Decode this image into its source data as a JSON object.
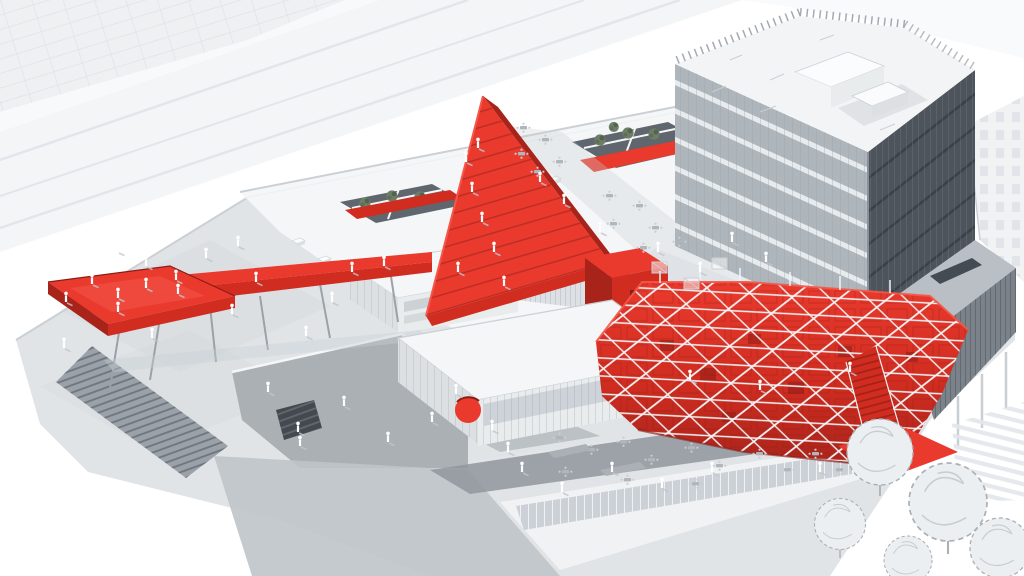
{
  "meta": {
    "title": "Aerial isometric architectural rendering of a white campus with bright red circulation structures",
    "medium": "3D architectural visualization",
    "view": "aerial axonometric"
  },
  "palette": {
    "bg": "#ffffff",
    "road": "#f3f5f7",
    "road_line": "#e2e6ea",
    "ghost": "#eef0f2",
    "ghost_line": "#dfe3e7",
    "ground": "#e0e4e7",
    "ground_sunken": "#abb0b5",
    "path_dark": "#90969c",
    "apron": "#bfc4c9",
    "plinth": "#f0f2f4",
    "roof_white": "#f4f6f8",
    "face_light": "#e9eced",
    "face_mid": "#dce0e3",
    "parapet": "#cbd0d4",
    "glass": "#bfc6cc",
    "mullion": "#9aa1a8",
    "louver_face": "#dde1e5",
    "louver_line": "#b6bcc2",
    "courtyard": "#5f666d",
    "tree": "#6e7e66",
    "tree_dark": "#4f5e49",
    "steps_fill": "#9aa1a8",
    "steps_line": "#6e757c",
    "stair_dark": "#44494f",
    "tower_roof": "#f2f4f6",
    "tower_left": "#aeb5bb",
    "tower_band": "#e8ebee",
    "tower_right": "#4e545c",
    "tower_right_line": "#6e757d",
    "tower_floor_dark": "#394046",
    "podium": "#7b828a",
    "podium_rib": "#585f66",
    "deck": "#b9bfc5",
    "red_top": "#e93a2d",
    "red_mid": "#d02c20",
    "red_dark": "#a8241b",
    "red_deep": "#8c1d15",
    "red_bright": "#f4564a",
    "lattice": "#f2f4f6",
    "shadow": "#c9cfd5",
    "people": "#ffffff",
    "people_shadow": "#c0c6cb",
    "sketch": "#c8cdd1",
    "sketch_line": "#a9b0b6",
    "furniture": "#c9ced3",
    "furniture_dark": "#b0b6bc"
  },
  "scene": {
    "background": "white",
    "elements": [
      {
        "name": "context-roads",
        "desc": "pale diagonal roads, upper left"
      },
      {
        "name": "context-building-grid",
        "desc": "ghosted gridded facade in top-left corner"
      },
      {
        "name": "context-building-windows",
        "desc": "pale punched-window building at right edge"
      },
      {
        "name": "plaza",
        "desc": "light gray paved ground plane with pedestrians"
      },
      {
        "name": "sunken-plaza",
        "desc": "darker sunken court with a small dark stair"
      },
      {
        "name": "plaza-stairs",
        "desc": "wide gray stair at lower left"
      },
      {
        "name": "red-ramp",
        "desc": "elevated red walkway on thin steel legs with a viewing platform"
      },
      {
        "name": "slab-building",
        "desc": "white slab block with two roof courtyards"
      },
      {
        "name": "roof-courtyards",
        "desc": "sunken courtyards with green trees crossed by red walkways"
      },
      {
        "name": "louver-bar",
        "desc": "louvered linear volume bridging the roofs"
      },
      {
        "name": "red-amphitheater",
        "desc": "triangular red roof stair occupied by people"
      },
      {
        "name": "red-mesh-pavilion",
        "desc": "faceted red hall wrapped in a white lattice frame"
      },
      {
        "name": "red-exit-stair",
        "desc": "red stair spilling to ground onto a red landing"
      },
      {
        "name": "office-tower",
        "desc": "glass tower: light west face, dark east face, white roof plant"
      },
      {
        "name": "podium-wall",
        "desc": "dark ribbed podium wall on slender columns"
      },
      {
        "name": "glass-pavilion",
        "desc": "low glazed pavilion with a round red entrance awning"
      },
      {
        "name": "terrace-cafe",
        "desc": "roof terraces with tables, chairs and counters"
      },
      {
        "name": "pedestrians",
        "desc": "small white human figures with soft shadows"
      },
      {
        "name": "sketch-trees",
        "desc": "gray sketch-style trees, lower right"
      },
      {
        "name": "crosswalk",
        "desc": "striped paving band, lower right"
      }
    ]
  }
}
